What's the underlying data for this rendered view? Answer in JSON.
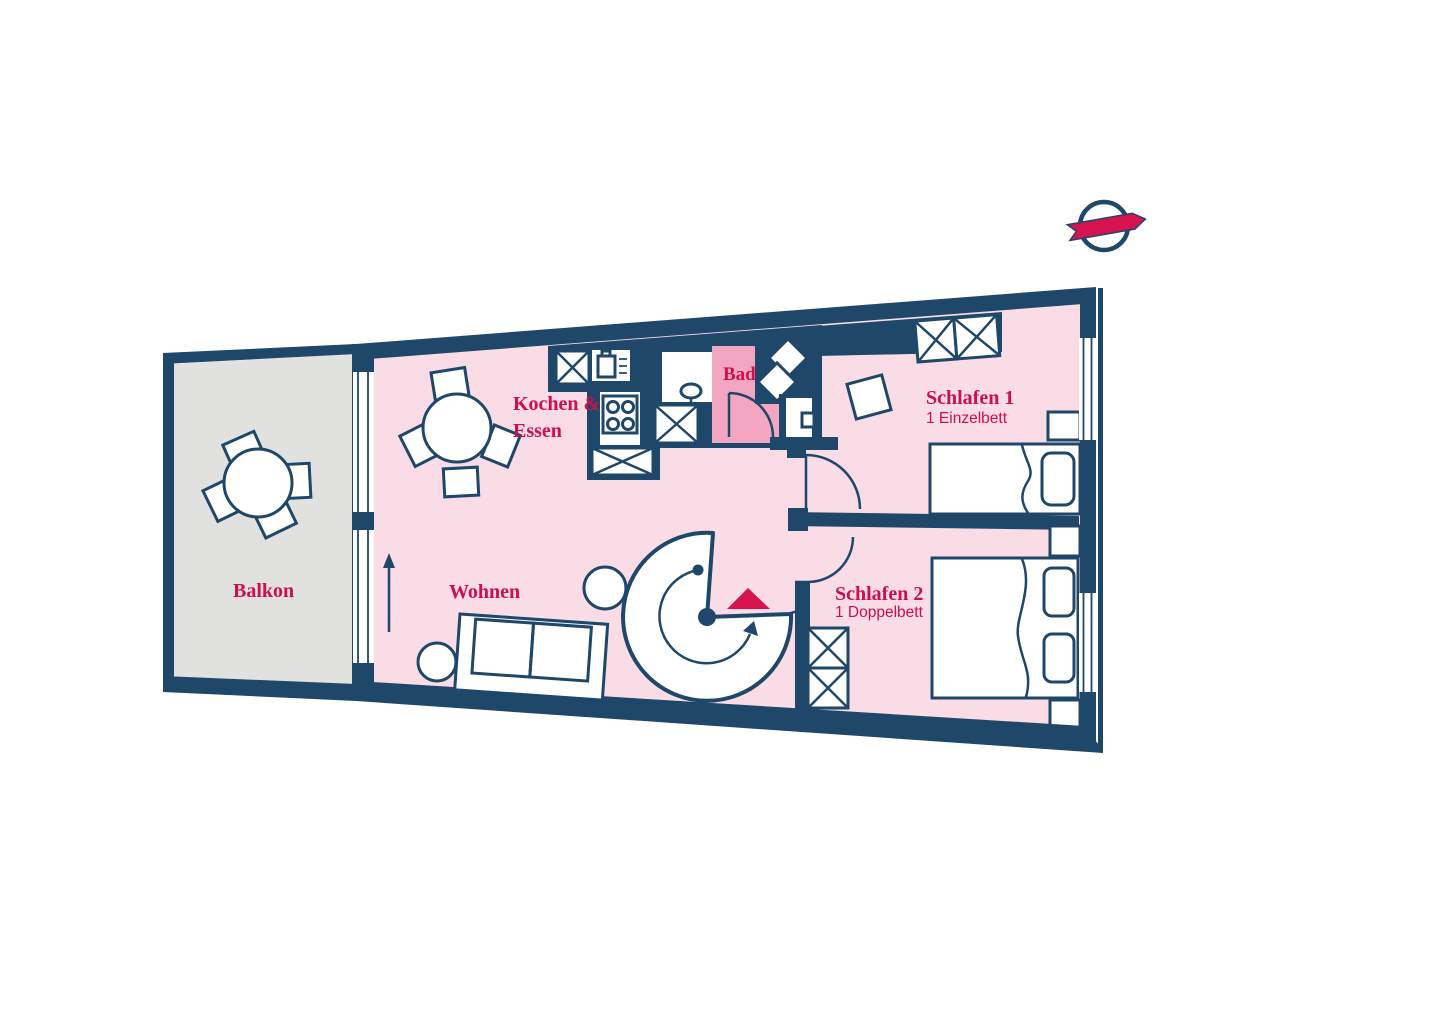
{
  "colors": {
    "wall_navy": "#1e4769",
    "accent_crimson": "#ce0f4d",
    "room_pink": "#f9dce6",
    "bath_pink": "#f3a6c1",
    "balcony_gray": "#e1e1e0",
    "white": "#ffffff"
  },
  "rooms": {
    "balcony": {
      "label": "Balkon"
    },
    "kitchen": {
      "label_line1": "Kochen &",
      "label_line2": "Essen"
    },
    "bath": {
      "label": "Bad"
    },
    "living": {
      "label": "Wohnen"
    },
    "bedroom1": {
      "label": "Schlafen 1",
      "sublabel": "1 Einzelbett"
    },
    "bedroom2": {
      "label": "Schlafen 2",
      "sublabel": "1 Doppelbett"
    }
  },
  "icons": [
    "dining-table-icon",
    "chair-icon",
    "kitchen-cabinet-icon",
    "sink-icon",
    "stove-icon",
    "washbasin-icon",
    "shower-icon",
    "toilet-icon",
    "wardrobe-icon",
    "single-bed-icon",
    "double-bed-icon",
    "nightstand-icon",
    "sofa-icon",
    "side-table-icon",
    "spiral-staircase-icon",
    "direction-arrow-icon",
    "entrance-triangle-icon",
    "window-icon",
    "door-swing-icon",
    "logo-ribbon-icon"
  ]
}
